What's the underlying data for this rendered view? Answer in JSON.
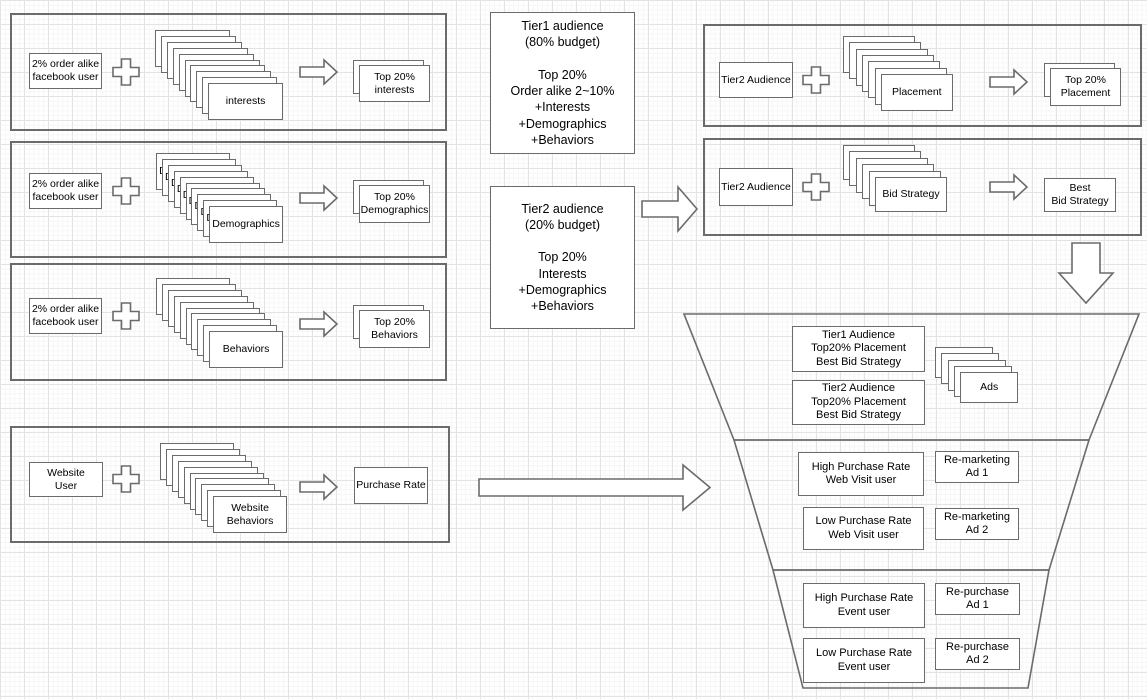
{
  "diagram": {
    "left_rows": [
      {
        "source": "2% order alike\nfacebook user",
        "stack": "interests",
        "result": "Top 20%\ninterests"
      },
      {
        "source": "2% order alike\nfacebook user",
        "stack": "Demographics",
        "result": "Top 20%\nDemographics"
      },
      {
        "source": "2% order alike\nfacebook user",
        "stack": "Behaviors",
        "result": "Top 20%\nBehaviors"
      },
      {
        "source": "Website\nUser",
        "stack": "Website\nBehaviors",
        "result": "Purchase Rate"
      }
    ],
    "tier1_note": "Tier1 audience\n(80% budget)\n\nTop 20%\nOrder alike 2~10%\n+Interests\n+Demographics\n+Behaviors",
    "tier2_note": "Tier2 audience\n(20% budget)\n\nTop 20%\nInterests\n+Demographics\n+Behaviors",
    "right_rows": [
      {
        "source": "Tier2 Audience",
        "stack": "Placement",
        "result": "Top 20%\nPlacement"
      },
      {
        "source": "Tier2 Audience",
        "stack": "Bid Strategy",
        "result": "Best\nBid Strategy"
      }
    ],
    "funnel": {
      "stage1": {
        "boxes": [
          "Tier1 Audience\nTop20% Placement\nBest Bid Strategy",
          "Tier2 Audience\nTop20% Placement\nBest Bid Strategy"
        ],
        "stack": "Ads"
      },
      "stage2": [
        {
          "audience": "High Purchase Rate\nWeb Visit user",
          "ad": "Re-marketing\nAd 1"
        },
        {
          "audience": "Low Purchase Rate\nWeb Visit user",
          "ad": "Re-marketing\nAd 2"
        }
      ],
      "stage3": [
        {
          "audience": "High Purchase Rate\nEvent user",
          "ad": "Re-purchase\nAd 1"
        },
        {
          "audience": "Low Purchase Rate\nEvent user",
          "ad": "Re-purchase\nAd 2"
        }
      ]
    },
    "colors": {
      "stroke": "#6b6b6b",
      "box_fill": "#ffffff",
      "text": "#000000",
      "grid_minor": "#f6f6f6",
      "grid_major": "#e3e3e3"
    }
  }
}
